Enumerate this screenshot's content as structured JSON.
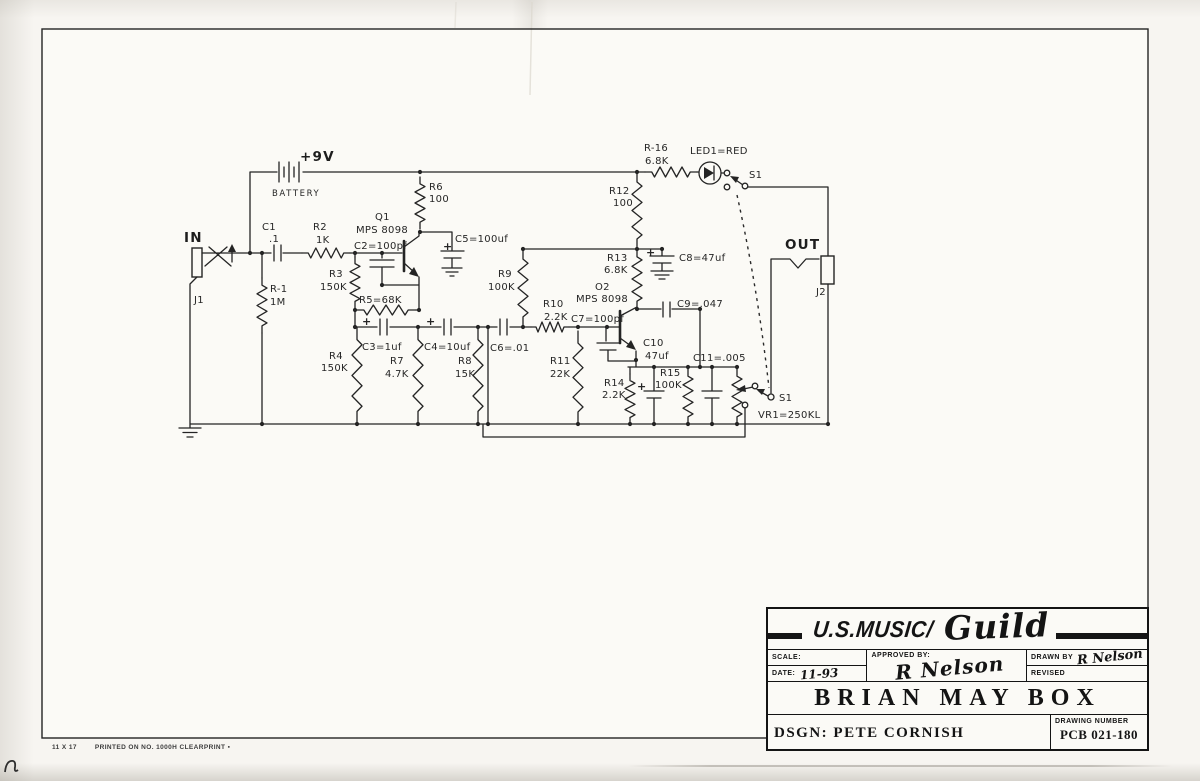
{
  "title_block": {
    "company_prefix": "U.S.MUSIC/",
    "company_script": "Guild",
    "scale_label": "SCALE:",
    "scale_value": "",
    "date_label": "DATE:",
    "date_value": "11-93",
    "approved_label": "APPROVED BY:",
    "approved_signature": "R Nelson",
    "drawn_label": "DRAWN BY",
    "drawn_signature": "R Nelson",
    "revised_label": "REVISED",
    "revised_value": "",
    "title": "BRIAN MAY BOX",
    "designer": "DSGN: PETE CORNISH",
    "drawing_number_label": "DRAWING NUMBER",
    "drawing_number": "PCB 021-180"
  },
  "footer": {
    "paper_size": "11 X 17",
    "print_note": "PRINTED ON NO. 1000H CLEARPRINT ▪"
  },
  "schematic": {
    "labels": [
      {
        "id": "supply",
        "t": "+9V",
        "x": 300,
        "y": 161,
        "cls": "big"
      },
      {
        "id": "battery",
        "t": "BATTERY",
        "x": 272,
        "y": 196,
        "cls": "med"
      },
      {
        "id": "in",
        "t": "IN",
        "x": 184,
        "y": 242,
        "cls": "big"
      },
      {
        "id": "j1",
        "t": "J1",
        "x": 194,
        "y": 303
      },
      {
        "id": "c1",
        "t": "C1",
        "x": 262,
        "y": 230
      },
      {
        "id": "c1-val",
        "t": ".1",
        "x": 269,
        "y": 242
      },
      {
        "id": "r2",
        "t": "R2",
        "x": 313,
        "y": 230
      },
      {
        "id": "r2-val",
        "t": "1K",
        "x": 316,
        "y": 243
      },
      {
        "id": "r3",
        "t": "R3",
        "x": 329,
        "y": 277
      },
      {
        "id": "r3-val",
        "t": "150K",
        "x": 320,
        "y": 290
      },
      {
        "id": "r1",
        "t": "R-1",
        "x": 270,
        "y": 292
      },
      {
        "id": "r1-val",
        "t": "1M",
        "x": 270,
        "y": 305
      },
      {
        "id": "q1",
        "t": "Q1",
        "x": 375,
        "y": 220
      },
      {
        "id": "q1-type",
        "t": "MPS 8098",
        "x": 356,
        "y": 233
      },
      {
        "id": "c2",
        "t": "C2=100pf",
        "x": 354,
        "y": 249
      },
      {
        "id": "r5",
        "t": "R5=68K",
        "x": 359,
        "y": 303
      },
      {
        "id": "r6",
        "t": "R6",
        "x": 429,
        "y": 190
      },
      {
        "id": "r6-val",
        "t": "100",
        "x": 429,
        "y": 202
      },
      {
        "id": "c5",
        "t": "C5=100uf",
        "x": 455,
        "y": 242
      },
      {
        "id": "r4",
        "t": "R4",
        "x": 329,
        "y": 359
      },
      {
        "id": "r4-val",
        "t": "150K",
        "x": 321,
        "y": 371
      },
      {
        "id": "c3",
        "t": "C3=1uf",
        "x": 362,
        "y": 350
      },
      {
        "id": "r7",
        "t": "R7",
        "x": 390,
        "y": 364
      },
      {
        "id": "r7-val",
        "t": "4.7K",
        "x": 385,
        "y": 377
      },
      {
        "id": "c4",
        "t": "C4=10uf",
        "x": 424,
        "y": 350
      },
      {
        "id": "r8",
        "t": "R8",
        "x": 458,
        "y": 364
      },
      {
        "id": "r8-val",
        "t": "15K",
        "x": 455,
        "y": 377
      },
      {
        "id": "c6",
        "t": "C6=.01",
        "x": 490,
        "y": 351
      },
      {
        "id": "r9",
        "t": "R9",
        "x": 498,
        "y": 277
      },
      {
        "id": "r9-val",
        "t": "100K",
        "x": 488,
        "y": 290
      },
      {
        "id": "r10",
        "t": "R10",
        "x": 543,
        "y": 307
      },
      {
        "id": "r10-val",
        "t": "2.2K",
        "x": 544,
        "y": 320
      },
      {
        "id": "c7",
        "t": "C7=100pf",
        "x": 571,
        "y": 322
      },
      {
        "id": "r11",
        "t": "R11",
        "x": 550,
        "y": 364
      },
      {
        "id": "r11-val",
        "t": "22K",
        "x": 550,
        "y": 377
      },
      {
        "id": "q2",
        "t": "O2",
        "x": 595,
        "y": 290
      },
      {
        "id": "q2-type",
        "t": "MPS 8098",
        "x": 576,
        "y": 302
      },
      {
        "id": "r12",
        "t": "R12",
        "x": 609,
        "y": 194
      },
      {
        "id": "r12-val",
        "t": "100",
        "x": 613,
        "y": 206
      },
      {
        "id": "r13",
        "t": "R13",
        "x": 607,
        "y": 261
      },
      {
        "id": "r13-val",
        "t": "6.8K",
        "x": 604,
        "y": 273
      },
      {
        "id": "c8",
        "t": "C8=47uf",
        "x": 679,
        "y": 261
      },
      {
        "id": "c9",
        "t": "C9=.047",
        "x": 677,
        "y": 307
      },
      {
        "id": "c10",
        "t": "C10",
        "x": 643,
        "y": 346
      },
      {
        "id": "c10-val",
        "t": "47uf",
        "x": 645,
        "y": 359
      },
      {
        "id": "r14",
        "t": "R14",
        "x": 604,
        "y": 386
      },
      {
        "id": "r14-val",
        "t": "2.2K",
        "x": 602,
        "y": 398
      },
      {
        "id": "r15",
        "t": "R15",
        "x": 660,
        "y": 376
      },
      {
        "id": "r15-val",
        "t": "100K",
        "x": 655,
        "y": 388
      },
      {
        "id": "c11",
        "t": "C11=.005",
        "x": 693,
        "y": 361
      },
      {
        "id": "vr1",
        "t": "VR1=250KL",
        "x": 758,
        "y": 418
      },
      {
        "id": "s1-lower",
        "t": "S1",
        "x": 779,
        "y": 401
      },
      {
        "id": "r16",
        "t": "R-16",
        "x": 644,
        "y": 151
      },
      {
        "id": "r16-val",
        "t": "6.8K",
        "x": 645,
        "y": 164
      },
      {
        "id": "led1",
        "t": "LED1=RED",
        "x": 690,
        "y": 154
      },
      {
        "id": "s1-upper",
        "t": "S1",
        "x": 749,
        "y": 178
      },
      {
        "id": "out",
        "t": "OUT",
        "x": 785,
        "y": 249,
        "cls": "big"
      },
      {
        "id": "j2",
        "t": "J2",
        "x": 816,
        "y": 295
      },
      {
        "id": "plus-c3",
        "t": "+",
        "x": 362,
        "y": 325,
        "cls": "plus"
      },
      {
        "id": "plus-c4",
        "t": "+",
        "x": 426,
        "y": 325,
        "cls": "plus"
      },
      {
        "id": "plus-c5",
        "t": "+",
        "x": 443,
        "y": 250,
        "cls": "plus"
      },
      {
        "id": "plus-c8",
        "t": "+",
        "x": 646,
        "y": 256,
        "cls": "plus"
      },
      {
        "id": "plus-c10",
        "t": "+",
        "x": 637,
        "y": 390,
        "cls": "plus"
      }
    ]
  }
}
